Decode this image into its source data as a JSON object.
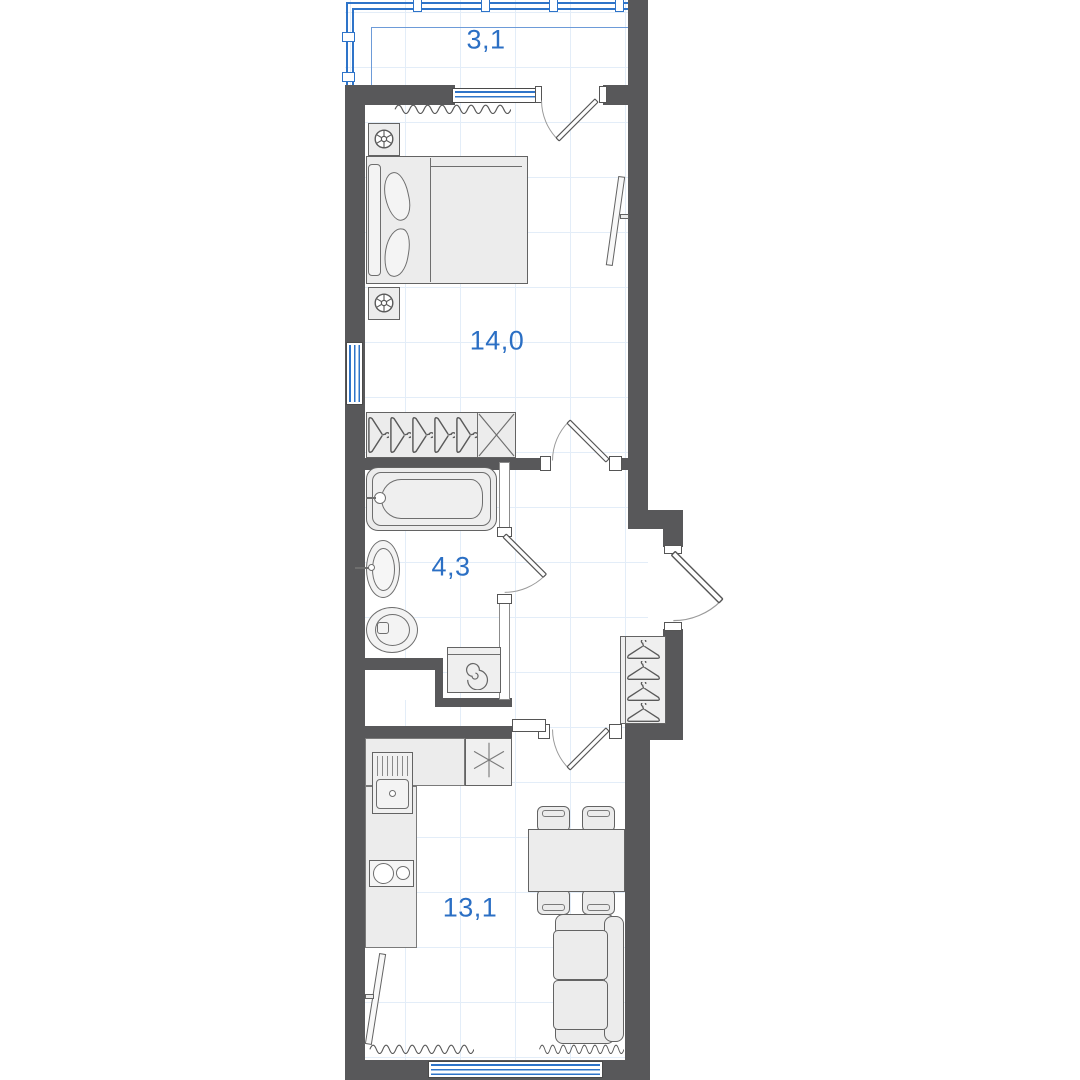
{
  "plan": {
    "type": "apartment floor plan",
    "area_unit": "m2",
    "rooms": [
      {
        "name": "balcony",
        "area_label": "3,1"
      },
      {
        "name": "bedroom",
        "area_label": "14,0"
      },
      {
        "name": "bathroom",
        "area_label": "4,3"
      },
      {
        "name": "kitchen-living-room",
        "area_label": "13,1"
      }
    ],
    "fixtures": [
      "double-bed",
      "nightstand-lamp",
      "nightstand-lamp",
      "tv-bedroom",
      "wardrobe-hangers",
      "wardrobe-shelf-crossed",
      "bathtub",
      "washbasin",
      "toilet",
      "washing-machine",
      "coat-rack-hangers",
      "kitchen-counter",
      "kitchen-sink",
      "cooktop",
      "refrigerator",
      "dining-table",
      "chair",
      "chair",
      "chair",
      "chair",
      "sofa",
      "tv-living",
      "radiator",
      "radiator",
      "radiator",
      "balcony-glazing",
      "window",
      "window",
      "window",
      "balcony-door",
      "bedroom-door",
      "bathroom-door",
      "entrance-door",
      "kitchen-door"
    ],
    "colors": {
      "wall": "#58585a",
      "glazing_blue": "#2e74c9",
      "label_blue": "#2b6fc4",
      "furniture_fill": "#ececec",
      "furniture_line": "#636363",
      "grid_line": "#e3edf8"
    }
  }
}
